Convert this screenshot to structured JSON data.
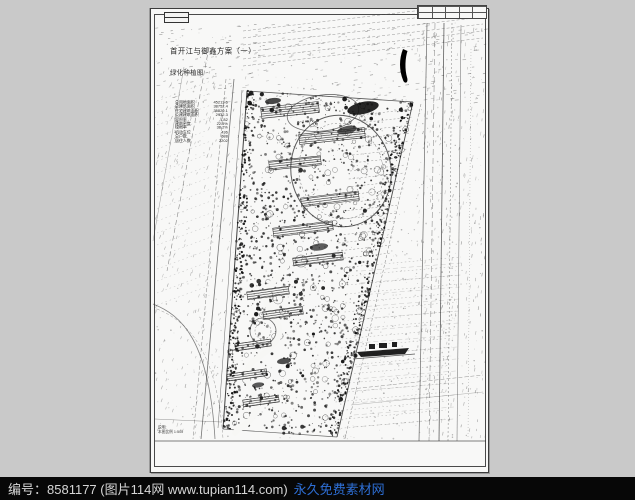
{
  "watermark": {
    "label": "编号：",
    "id": "8581177",
    "source": "(图片114网 www.tupian114.com)",
    "site": "永久免费素材网",
    "bar_bg": "#070707",
    "text_color": "#d6d6d6",
    "link_color": "#2e6fd6"
  },
  "sheet": {
    "title_line1": "首开江与御鑫方案（一）",
    "title_line2": "绿化种植图",
    "paper_color": "#f8f8f7",
    "ink_color": "#1c1c1c"
  },
  "notes": [
    "说明:",
    "本图比例 1:500"
  ],
  "indicators": [
    {
      "name": "总用地面积",
      "value": "45213.6"
    },
    {
      "name": "总建筑面积",
      "value": "38752.4"
    },
    {
      "name": "住宅建筑面积",
      "value": "35820.1"
    },
    {
      "name": "公建建筑面积",
      "value": "2932.3"
    },
    {
      "name": "容积率",
      "value": "1.82"
    },
    {
      "name": "建筑密度",
      "value": "22.5%"
    },
    {
      "name": "绿地率",
      "value": "38.2%"
    },
    {
      "name": "机动车位",
      "value": "436"
    },
    {
      "name": "总户数",
      "value": "688"
    },
    {
      "name": "居住人数",
      "value": "2202"
    }
  ],
  "titleblock": {
    "rows": 2,
    "cols": 5
  },
  "drawing": {
    "seed": 42,
    "viewbox": "0 0 339 465",
    "frame": {
      "x": 3.5,
      "y": 5.5,
      "w": 331,
      "h": 452,
      "stroke": "#4a4a4a"
    },
    "rows": [
      {
        "y0": 106,
        "y1": 252,
        "step": 8,
        "x": 208,
        "drift": -0.16,
        "len": 55,
        "dy": -6,
        "dash": "2 2",
        "sw": 0.5,
        "op": 0.5
      },
      {
        "y0": 258,
        "y1": 428,
        "step": 9,
        "x": 198,
        "drift": -0.1,
        "len": 112,
        "dy": -10,
        "dash": "1.5 2.5",
        "sw": 0.45,
        "op": 0.4
      },
      {
        "y0": 22,
        "y1": 58,
        "step": 7,
        "x": 92,
        "drift": 0,
        "len": 240,
        "dy": -28,
        "dash": "3 2",
        "sw": 0.5,
        "op": 0.5
      },
      {
        "y0": 92,
        "y1": 300,
        "step": 12,
        "x": 6,
        "drift": 0,
        "len": 54,
        "dy": -20,
        "dash": "1.5 3",
        "sw": 0.4,
        "op": 0.35
      },
      {
        "y0": 262,
        "y1": 428,
        "step": 12,
        "x": 210,
        "drift": -0.05,
        "len": 100,
        "dy": -8,
        "dash": "5 3",
        "sw": 0.35,
        "op": 0.35
      }
    ],
    "lines": [
      [
        96,
        82,
        72,
        420,
        1,
        "",
        0.9
      ],
      [
        91,
        81,
        67,
        419,
        0.5,
        "",
        0.7
      ],
      [
        83,
        70,
        50,
        430,
        0.8,
        "",
        0.65
      ],
      [
        75,
        70,
        42,
        430,
        0.5,
        "4 2",
        0.6
      ],
      [
        58,
        38,
        16,
        262,
        0.6,
        "5 3",
        0.55
      ],
      [
        33,
        58,
        2,
        232,
        0.5,
        "",
        0.45
      ],
      [
        262,
        93,
        186,
        428,
        0.9,
        "",
        0.85
      ],
      [
        270,
        95,
        194,
        430,
        0.5,
        "3 2",
        0.6
      ],
      [
        276,
        14,
        268,
        432,
        0.7,
        "",
        0.7
      ],
      [
        284,
        14,
        278,
        432,
        0.5,
        "6 3",
        0.6
      ],
      [
        293,
        14,
        288,
        432,
        0.8,
        "",
        0.75
      ],
      [
        301,
        14,
        297,
        432,
        0.5,
        "2 2",
        0.6
      ],
      [
        310,
        16,
        306,
        432,
        0.6,
        "",
        0.6
      ],
      [
        320,
        40,
        317,
        430,
        0.4,
        "1 2",
        0.5
      ],
      [
        200,
        380,
        332,
        366,
        0.5,
        "4 2",
        0.5
      ],
      [
        200,
        396,
        332,
        383,
        0.4,
        "",
        0.45
      ],
      [
        4,
        410,
        70,
        413,
        0.5,
        "",
        0.5
      ],
      [
        4,
        432,
        335,
        432,
        0.8,
        "",
        0.8
      ],
      [
        96,
        82,
        262,
        93,
        0.8,
        "",
        0.8
      ],
      [
        72,
        420,
        186,
        428,
        0.7,
        "",
        0.7
      ],
      [
        202,
        350,
        264,
        345,
        0.7,
        "",
        0.8
      ]
    ],
    "paths": [
      {
        "d": "M 2 295 C 30 306 58 330 64 430",
        "stroke": "#333",
        "sw": 0.8,
        "dash": "",
        "op": 0.6
      },
      {
        "d": "M 6 300 C 36 312 66 340 72 430",
        "stroke": "#333",
        "sw": 0.5,
        "dash": "3 2",
        "op": 0.5
      }
    ],
    "whitepath": {
      "d": "M 138 232 C 150 252 122 266 116 284 C 110 302 136 312 126 330 C 116 348 98 348 96 364 C 94 380 112 388 104 404 C 98 416 88 418 84 424",
      "stroke": "#f7f7f5",
      "sw": 6
    },
    "scatter": [
      {
        "poly": [
          [
            4,
            14
          ],
          [
            334,
            14
          ],
          [
            334,
            430
          ],
          [
            4,
            430
          ]
        ],
        "n": 600,
        "type": "dot",
        "rmin": 0.3,
        "rmax": 0.8,
        "color": "#333",
        "opmin": 0.18,
        "opmax": 0.4
      },
      {
        "poly": [
          [
            4,
            14
          ],
          [
            334,
            14
          ],
          [
            334,
            95
          ],
          [
            4,
            95
          ]
        ],
        "n": 230,
        "type": "dash",
        "rmin": 2,
        "rmax": 4,
        "angle": -8,
        "color": "#333",
        "opmin": 0.3,
        "opmax": 0.55
      },
      {
        "poly": [
          [
            266,
            14
          ],
          [
            334,
            14
          ],
          [
            334,
            430
          ],
          [
            266,
            430
          ]
        ],
        "n": 260,
        "type": "dash",
        "rmin": 2,
        "rmax": 4,
        "angle": -82,
        "color": "#333",
        "opmin": 0.25,
        "opmax": 0.5
      },
      {
        "poly": [
          [
            4,
            60
          ],
          [
            96,
            60
          ],
          [
            72,
            430
          ],
          [
            4,
            430
          ]
        ],
        "n": 200,
        "type": "dash",
        "rmin": 2,
        "rmax": 4,
        "angle": -72,
        "color": "#333",
        "opmin": 0.25,
        "opmax": 0.45
      },
      {
        "poly": [
          [
            264,
            95
          ],
          [
            308,
            95
          ],
          [
            302,
            430
          ],
          [
            190,
            430
          ]
        ],
        "n": 160,
        "type": "dot",
        "rmin": 0.3,
        "rmax": 0.9,
        "color": "#333",
        "opmin": 0.2,
        "opmax": 0.4
      },
      {
        "poly": [
          [
            96,
            82
          ],
          [
            262,
            93
          ],
          [
            186,
            428
          ],
          [
            72,
            420
          ]
        ],
        "n": 1250,
        "type": "dot",
        "rmin": 0.4,
        "rmax": 1.5,
        "color": "#1c1c1c",
        "opmin": 0.45,
        "opmax": 0.9
      },
      {
        "poly": [
          [
            96,
            82
          ],
          [
            262,
            93
          ],
          [
            186,
            428
          ],
          [
            72,
            420
          ]
        ],
        "n": 120,
        "type": "ring",
        "rmin": 1.8,
        "rmax": 3.4,
        "color": "#2a2a2a",
        "opmin": 0.5,
        "opmax": 0.8
      },
      {
        "poly": [
          [
            96,
            82
          ],
          [
            262,
            93
          ],
          [
            186,
            428
          ],
          [
            72,
            420
          ]
        ],
        "n": 45,
        "type": "dot",
        "rmin": 1.2,
        "rmax": 2.4,
        "color": "#0d0d0d",
        "opmin": 0.8,
        "opmax": 0.95
      },
      {
        "poly": [
          [
            96,
            82
          ],
          [
            104,
            83
          ],
          [
            82,
            421
          ],
          [
            72,
            420
          ]
        ],
        "n": 240,
        "type": "dot",
        "rmin": 0.5,
        "rmax": 1.3,
        "color": "#111",
        "opmin": 0.7,
        "opmax": 1
      },
      {
        "poly": [
          [
            252,
            92
          ],
          [
            262,
            93
          ],
          [
            186,
            428
          ],
          [
            176,
            427
          ]
        ],
        "n": 240,
        "type": "dot",
        "rmin": 0.5,
        "rmax": 1.3,
        "color": "#111",
        "opmin": 0.7,
        "opmax": 1
      }
    ],
    "buildings": [
      [
        139,
        101,
        58,
        11,
        -6
      ],
      [
        181,
        127,
        66,
        10,
        -6
      ],
      [
        144,
        154,
        52,
        9,
        -6
      ],
      [
        179,
        190,
        58,
        9,
        -7
      ],
      [
        152,
        220,
        60,
        9,
        -7
      ],
      [
        167,
        250,
        50,
        8,
        -7
      ],
      [
        117,
        284,
        42,
        8,
        -8
      ],
      [
        132,
        304,
        40,
        8,
        -8
      ],
      [
        102,
        336,
        36,
        7,
        -8
      ],
      [
        96,
        366,
        40,
        7,
        -8
      ],
      [
        110,
        392,
        36,
        7,
        -8
      ]
    ],
    "ellipses": [
      [
        190,
        162,
        50,
        56,
        -12,
        1,
        "",
        0.8
      ],
      [
        190,
        162,
        42,
        48,
        -12,
        0.5,
        "2 2",
        0.6
      ],
      [
        172,
        104,
        36,
        18,
        -8,
        0.8,
        "",
        0.7
      ],
      [
        112,
        322,
        13,
        13,
        0,
        0.8,
        "",
        0.7
      ],
      [
        112,
        322,
        8,
        8,
        0,
        0.5,
        "2 1.5",
        0.6
      ],
      [
        150,
        252,
        6,
        6,
        0,
        0.6,
        "",
        0.6
      ],
      [
        127,
        290,
        5,
        5,
        0,
        0.5,
        "",
        0.55
      ]
    ],
    "solids": [
      {
        "ellipse": [
          212,
          99,
          16,
          6,
          -12
        ],
        "fill": "#0f0f0f",
        "op": 0.9
      },
      {
        "ellipse": [
          196,
          121,
          10,
          4,
          -12
        ],
        "fill": "#222",
        "op": 0.75
      },
      {
        "ellipse": [
          122,
          92,
          8,
          3,
          -6
        ],
        "fill": "#1a1a1a",
        "op": 0.8
      },
      {
        "ellipse": [
          168,
          238,
          9,
          3.5,
          -8
        ],
        "fill": "#1a1a1a",
        "op": 0.7
      },
      {
        "ellipse": [
          133,
          352,
          7,
          3,
          -8
        ],
        "fill": "#161616",
        "op": 0.75
      },
      {
        "ellipse": [
          107,
          376,
          6,
          2.5,
          -8
        ],
        "fill": "#161616",
        "op": 0.7
      },
      {
        "d": "M 252 40 C 248 50 248 61 252 71 C 253.5 75.5 257.5 74 256.2 69 C 253.5 60 254.2 49 256.5 42 Z",
        "fill": "#000",
        "op": 1
      },
      {
        "d": "M 206 343 L 258 339 L 254 345 L 210 348 Z",
        "fill": "#141414",
        "op": 0.95
      },
      {
        "d": "M 218 335 h 6 v 5 h -6 z M 228 334 h 8 v 5 h -8 z M 241 333 h 5 v 5 h -5 z",
        "fill": "#141414",
        "op": 0.95
      }
    ]
  }
}
